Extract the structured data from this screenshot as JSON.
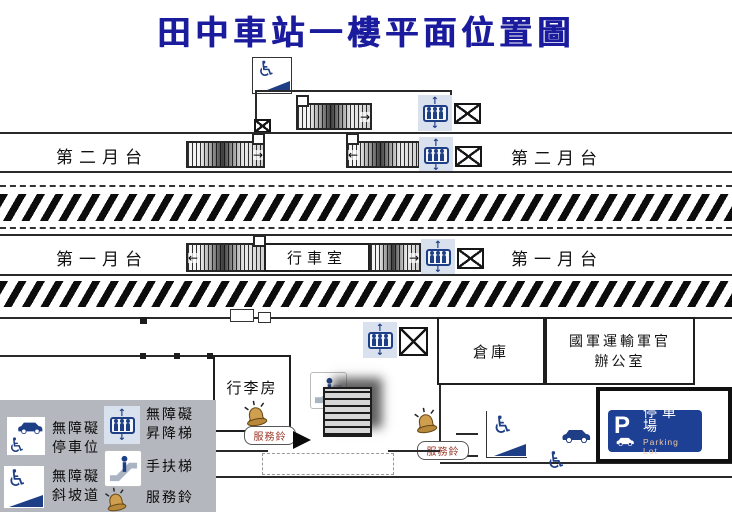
{
  "title": "田中車站一樓平面位置圖",
  "colors": {
    "title": "#1b1b9e",
    "navy": "#1e3f85",
    "icon_bg": "#d9e1ee",
    "legend_bg": "#b4b7be",
    "sign_bg": "#1d3f94",
    "sign_en": "#f0c9a2",
    "bubble_text": "#993222"
  },
  "icons": {
    "wheelchair": "♿",
    "up_arrow": "↑",
    "down_arrow": "↓"
  },
  "platforms": {
    "p2_left": "第二月台",
    "p2_right": "第二月台",
    "p1_left": "第一月台",
    "p1_right": "第一月台"
  },
  "rooms": {
    "operations": "行車室",
    "luggage": "行李房",
    "warehouse": "倉庫",
    "military_office_line1": "國軍運輸軍官",
    "military_office_line2": "辦公室"
  },
  "service_bells": {
    "bell1": "服務鈴",
    "bell2": "服務鈴"
  },
  "parking_sign": {
    "p": "P",
    "zh": "停車場",
    "en": "Parking Lot"
  },
  "legend": {
    "items": [
      {
        "icon": "accessible-parking-icon",
        "line1": "無障礙",
        "line2": "停車位"
      },
      {
        "icon": "accessible-elevator-icon",
        "line1": "無障礙",
        "line2": "昇降梯"
      },
      {
        "icon": "accessible-ramp-icon",
        "line1": "無障礙",
        "line2": "斜坡道"
      },
      {
        "icon": "escalator-icon",
        "line1": "手扶梯",
        "line2": ""
      },
      {
        "icon": "service-bell-icon",
        "line1": "服務鈴",
        "line2": ""
      }
    ]
  }
}
